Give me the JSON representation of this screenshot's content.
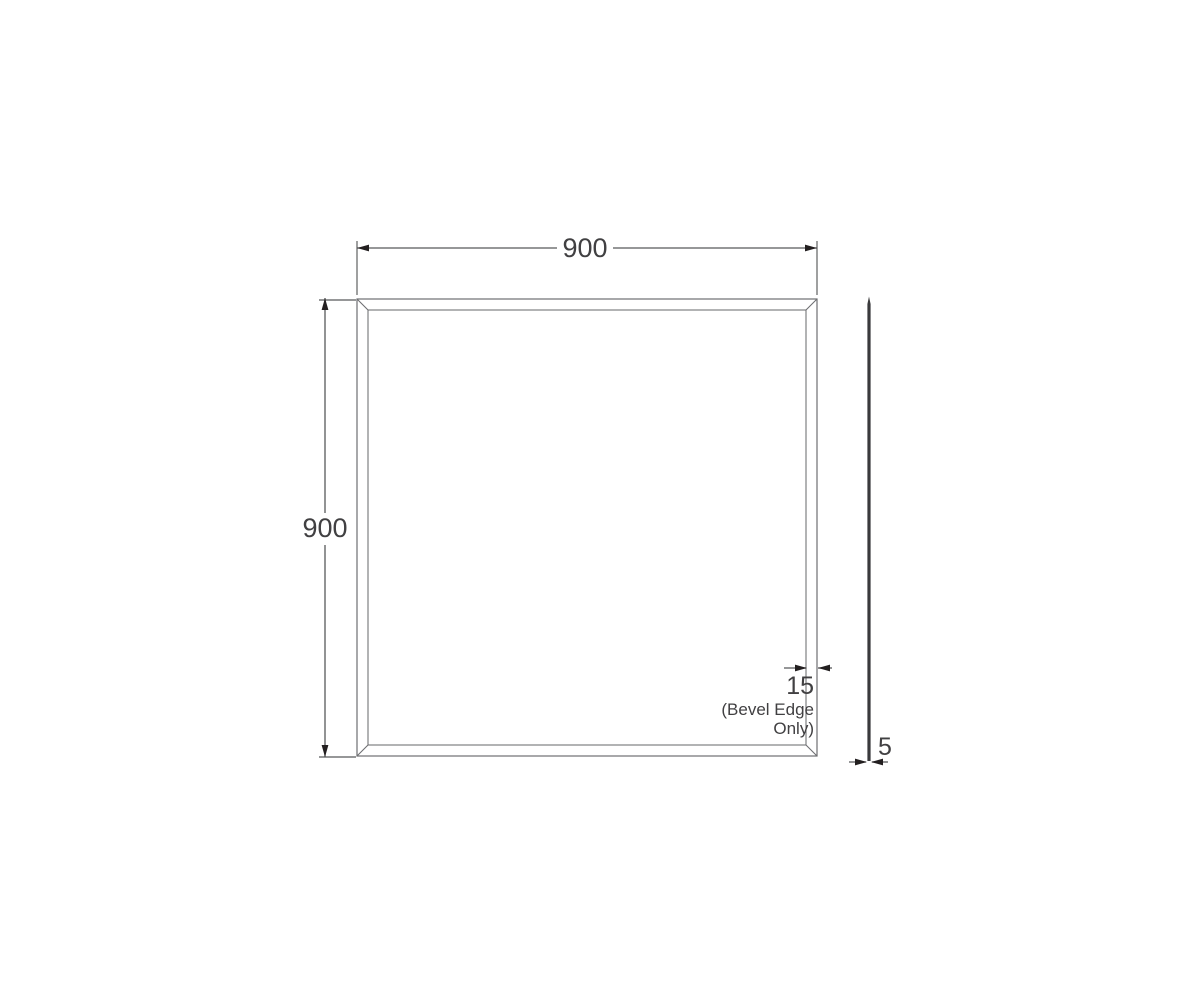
{
  "drawing": {
    "width_dimension": {
      "label": "900"
    },
    "height_dimension": {
      "label": "900"
    },
    "bevel_dimension": {
      "label": "15",
      "note_line1": "(Bevel Edge",
      "note_line2": "Only)"
    },
    "thickness_dimension": {
      "label": "5"
    },
    "colors": {
      "outline": "#6d6e71",
      "dimension": "#58595b",
      "arrow": "#231f20",
      "text": "#414042",
      "side_profile": "#3a3a3c",
      "background": "#ffffff"
    }
  }
}
